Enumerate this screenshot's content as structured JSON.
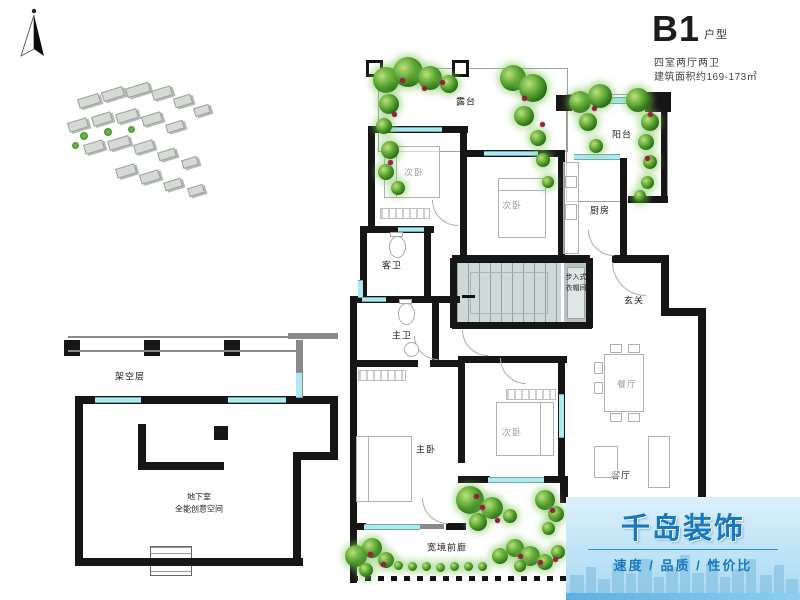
{
  "header": {
    "unit_code": "B1",
    "unit_suffix": "户型",
    "spec": "四室两厅两卫",
    "area": "建筑面积约169-173㎡"
  },
  "rooms": {
    "terrace": "露台",
    "balcony": "阳台",
    "bedroom_top": "次卧",
    "bedroom_mid": "次卧",
    "bedroom_bottom": "次卧",
    "master_bedroom": "主卧",
    "kitchen": "厨房",
    "guest_bathroom": "客卫",
    "master_bathroom": "主卫",
    "foyer": "玄关",
    "dining_room": "餐厅",
    "living_room": "客厅",
    "closet_line1": "步入式",
    "closet_line2": "衣帽间",
    "stilt_floor": "架空层",
    "basement_title": "地下室",
    "basement_subtitle": "全能创意空间",
    "front_porch": "宽境前廊"
  },
  "logo": {
    "brand": "千岛装饰",
    "tagline": "速度 / 品质 / 性价比"
  },
  "colors": {
    "wall": "#161616",
    "window": "#aee8f0",
    "plant_green": "#3c8f26",
    "flower_red": "#9c1f46",
    "stair_fill": "#cdd8d8",
    "brand_blue": "#1779bd",
    "logo_bg_top": "#ddf0fb",
    "logo_bg_bottom": "#a9d9f2"
  }
}
